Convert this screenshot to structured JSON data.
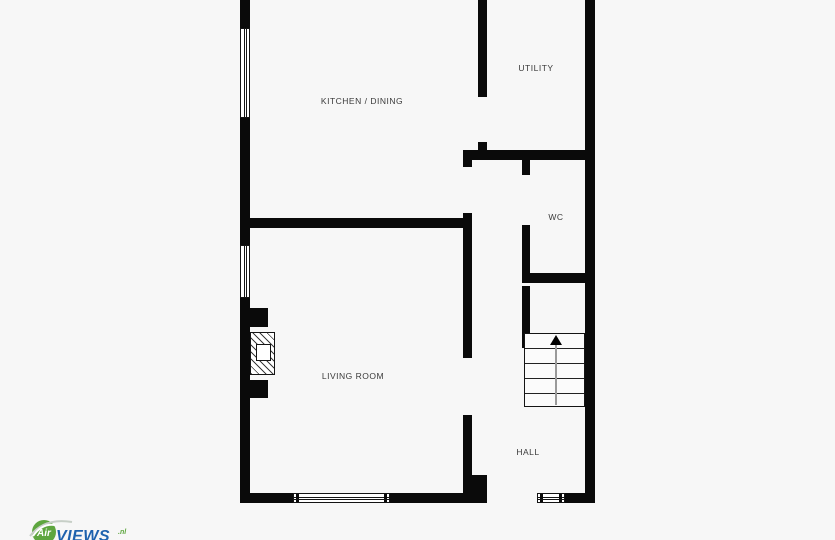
{
  "canvas": {
    "width": 835,
    "height": 540,
    "background_color": "#f7f7f7",
    "wall_color": "#0a0a0a",
    "label_color": "#3a3a3a"
  },
  "floorplan": {
    "type": "ground-floor-plan",
    "rooms": [
      {
        "name": "kitchen-dining",
        "label": "KITCHEN / DINING"
      },
      {
        "name": "utility",
        "label": "UTILITY"
      },
      {
        "name": "wc",
        "label": "WC"
      },
      {
        "name": "living-room",
        "label": "LIVING ROOM"
      },
      {
        "name": "hall",
        "label": "HALL"
      }
    ],
    "features": {
      "staircase": {
        "direction": "up",
        "treads": 5
      },
      "fireplace": "chimney breast with hatched hearth in living room",
      "windows": 4,
      "door_openings": 5
    }
  },
  "logo": {
    "circle_text": "Air",
    "brand_text": "VIEWS",
    "suffix": ".nl",
    "circle_color": "#5ea63f",
    "brand_color": "#1e62ae"
  }
}
